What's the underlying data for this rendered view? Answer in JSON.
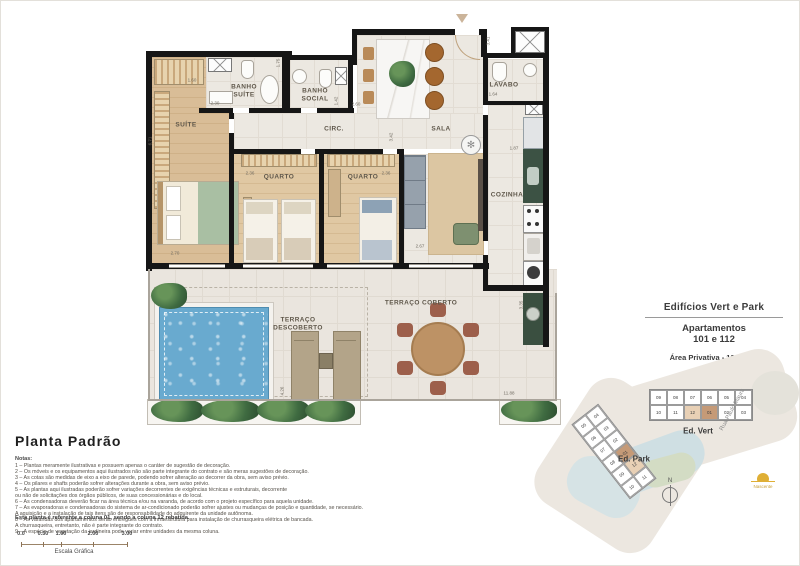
{
  "floorplan": {
    "rooms": {
      "suite": "SUÍTE",
      "banho_suite": "BANHO\nSUÍTE",
      "banho_social": "BANHO\nSOCIAL",
      "circ": "CIRC.",
      "sala": "SALA",
      "lavabo": "LAVABO",
      "quarto1": "QUARTO",
      "quarto2": "QUARTO",
      "cozinha": "COZINHA",
      "terraco_coberto": "TERRAÇO COBERTO",
      "terraco_descoberto": "TERRAÇO\nDESCOBERTO"
    },
    "dimensions": [
      "3.41",
      "1.75",
      "2.30",
      "1.42",
      "2.60",
      "1.60",
      "2.36",
      "2.36",
      "3.42",
      "2.70",
      "2.67",
      "1.64",
      "1.87",
      "3.35",
      "11.88",
      "4.26",
      "6.71"
    ]
  },
  "info_panel": {
    "title": "Edifícios Vert e Park",
    "subtitle1": "Apartamentos",
    "subtitle2": "101 e 112",
    "area": "Área Privativa - 129,42m²"
  },
  "site_plan": {
    "ed_vert": {
      "label": "Ed. Vert",
      "cells": [
        {
          "n": "09"
        },
        {
          "n": "08"
        },
        {
          "n": "07"
        },
        {
          "n": "06"
        },
        {
          "n": "05"
        },
        {
          "n": "04"
        },
        {
          "n": "10"
        },
        {
          "n": "11"
        },
        {
          "n": "12",
          "hl": "light"
        },
        {
          "n": "01",
          "hl": "dark"
        },
        {
          "n": "02"
        },
        {
          "n": "03"
        }
      ]
    },
    "ed_park": {
      "label": "Ed. Park",
      "cells": [
        {
          "n": "05"
        },
        {
          "n": "04"
        },
        {
          "n": "06"
        },
        {
          "n": "03"
        },
        {
          "n": "07"
        },
        {
          "n": "02"
        },
        {
          "n": "08"
        },
        {
          "n": "01",
          "hl": "dark"
        },
        {
          "n": "09"
        },
        {
          "n": "12",
          "hl": "light"
        },
        {
          "n": "10"
        },
        {
          "n": "11"
        }
      ]
    },
    "street": "Rua Paulo Maura",
    "compass": "N",
    "sun_label": "Nascente"
  },
  "legend": {
    "title": "Planta Padrão",
    "notes_heading": "Notas:",
    "notes": [
      "1 – Plantas meramente ilustrativas e possuem apenas o caráter de sugestão de decoração.",
      "2 – Os móveis e os equipamentos aqui ilustrados não são parte integrante do contrato e são meras sugestões de decoração.",
      "3 – As cotas são medidas de eixo a eixo de parede, podendo sofrer alteração ao decorrer da obra, sem aviso prévio.",
      "4 – Os pilares e shafts poderão sofrer alterações durante a obra, sem aviso prévio.",
      "5 – As plantas aqui ilustradas poderão sofrer variações decorrentes de exigências técnicas e estruturais, decorrente\nou não de solicitações dos órgãos públicos, de suas concessionárias e do local.",
      "6 – As condensadoras deverão ficar na área técnica e/ou na varanda, de acordo com o projeto específico para aquela unidade.",
      "7 – As evaporadoras e condensadoras do sistema de ar-condicionado poderão sofrer ajustes ou mudanças de posição e quantidade, se necessário.\nA aquisição e a instalação de tais itens são de responsabilidade do adquirente da unidade autônoma.",
      "8 – As varandas dos apartamentos serão entregues com a infraestrutura para instalação de churrasqueira elétrica de bancada.\nA churrasqueira, entretanto, não é parte integrante do contrato.",
      "9 – A espécie de vegetação da jardineira pode variar entre unidades da mesma coluna."
    ],
    "column_note": "Esta planta é referente a coluna 01, sendo a coluna 12 rebatida.",
    "scale_ticks": [
      "0.0",
      "0.50",
      "1.00",
      "2.00",
      "3.00"
    ],
    "scale_label": "Escala Gráfica"
  },
  "colors": {
    "wall": "#161616",
    "pool": "#69aacf",
    "wood": "#d9bd97",
    "highlight_dark": "#c59a77",
    "highlight_light": "#e8d0b5",
    "sun": "#dfaf35"
  }
}
